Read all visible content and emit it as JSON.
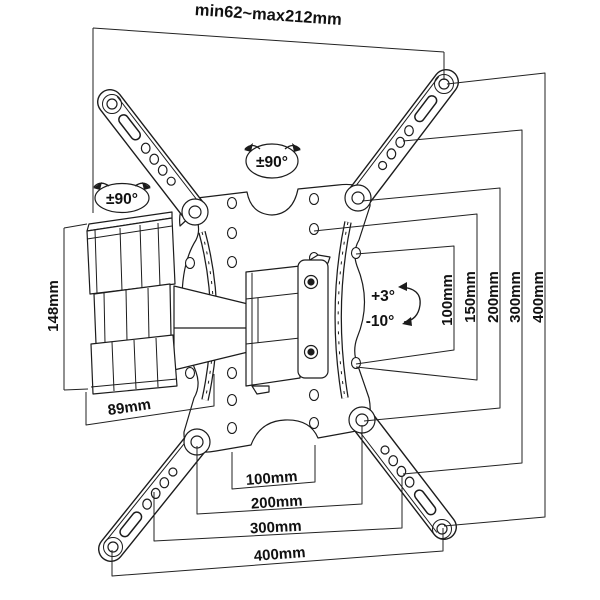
{
  "diagram": {
    "type": "technical-line-drawing",
    "subject": "full-motion TV wall mount with dimension annotations",
    "colors": {
      "background": "#ffffff",
      "line": "#1c1c1c",
      "text": "#111111"
    },
    "dims": {
      "top_extension": "min62~max212mm",
      "right_vertical": [
        "100mm",
        "150mm",
        "200mm",
        "300mm",
        "400mm"
      ],
      "bottom_horizontal": [
        "100mm",
        "200mm",
        "300mm",
        "400mm"
      ],
      "arm_height": "148mm",
      "arm_depth": "89mm"
    },
    "angles": {
      "swivel_arm": "±90°",
      "swivel_plate": "±90°",
      "tilt_up": "+3°",
      "tilt_down": "-10°"
    }
  }
}
